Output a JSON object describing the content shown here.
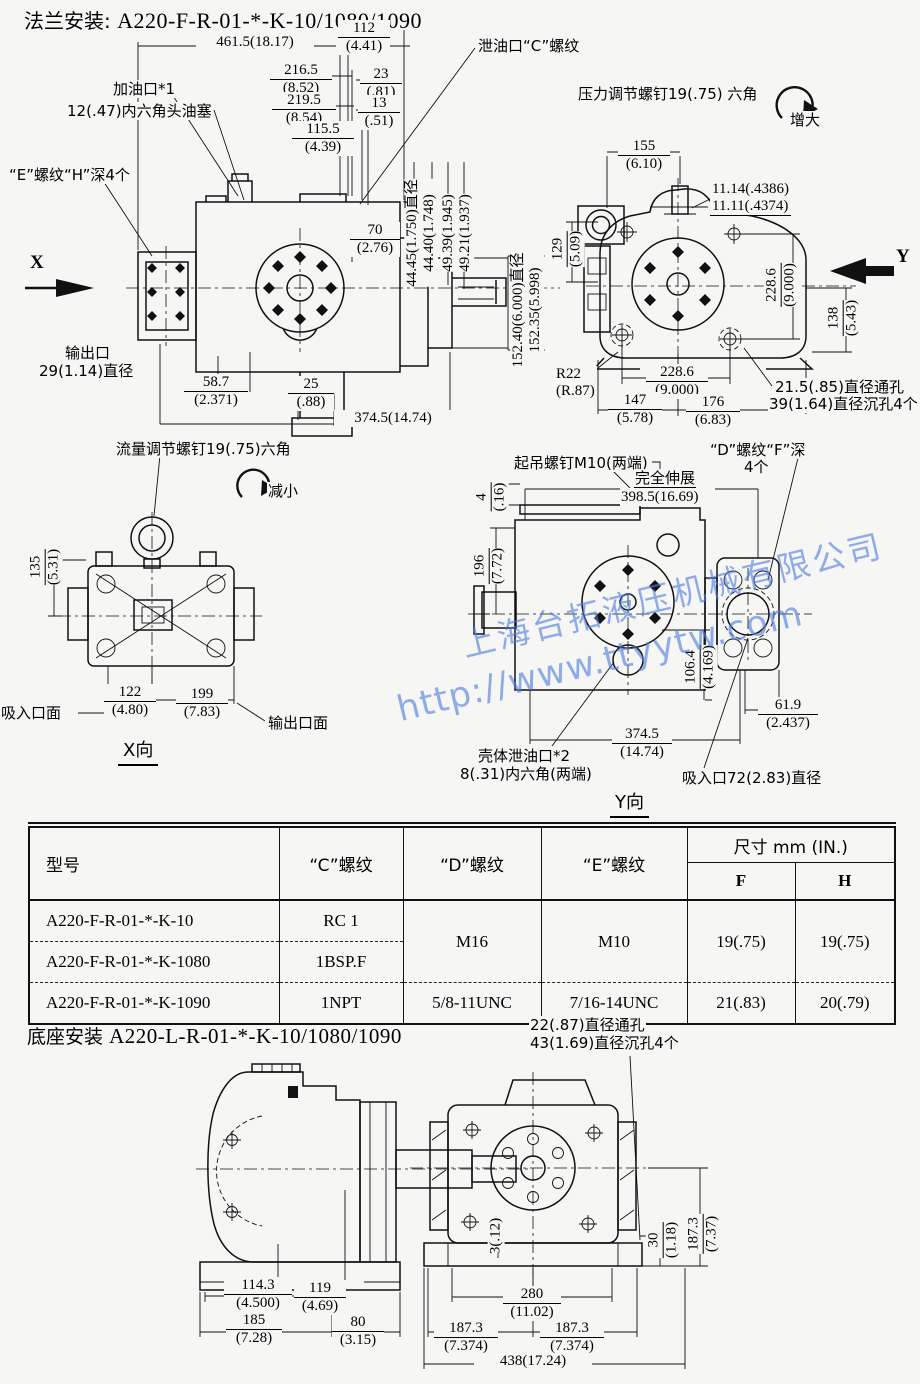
{
  "title": {
    "prefix": "法兰安装:",
    "model": "A220-F-R-01-*-K-10/1080/1090"
  },
  "watermark": {
    "line1": "上海台拓液压机械有限公司",
    "line2": "http://www.ttyytw.com"
  },
  "flange_view": {
    "labels": {
      "fill_port": "加油口*1",
      "plug": "12(.47)内六角头油塞",
      "e_thread": "“E”螺纹“H”深4个",
      "drain_port": "泄油口“C”螺纹",
      "outlet_line1": "输出口",
      "outlet_line2": "29(1.14)直径",
      "x_arrow": "X"
    },
    "dims": {
      "overall": "461.5(18.17)",
      "d112": {
        "mm": "112",
        "in": "(4.41)"
      },
      "d216": {
        "mm": "216.5",
        "in": "(8.52)"
      },
      "d23": {
        "mm": "23",
        "in": "(.81)"
      },
      "d219": {
        "mm": "219.5",
        "in": "(8.54)"
      },
      "d13": {
        "mm": "13",
        "in": "(.51)"
      },
      "d115": {
        "mm": "115.5",
        "in": "(4.39)"
      },
      "d70": {
        "mm": "70",
        "in": "(2.76)"
      },
      "shaft_dia1": "44.45(1.750)直径",
      "shaft_dia2": "44.40(1.748)",
      "key1": "49.39(1.945)",
      "key2": "49.21(1.937)",
      "pilot1": "152.40(6.000)直径",
      "pilot2": "152.35(5.998)",
      "d587": {
        "mm": "58.7",
        "in": "(2.371)"
      },
      "d25": {
        "mm": "25",
        "in": "(.88)"
      },
      "length": "374.5(14.74)"
    }
  },
  "y_face_view": {
    "labels": {
      "pressure_screw": "压力调节螺钉19(.75) 六角",
      "increase": "增大",
      "y_arrow": "Y",
      "hole1": "21.5(.85)直径通孔",
      "hole2": "39(1.64)直径沉孔4个",
      "r22_line1": "R22",
      "r22_line2": "(R.87)"
    },
    "dims": {
      "d155": {
        "mm": "155",
        "in": "(6.10)"
      },
      "stud1": "11.14(.4386)",
      "stud2": "11.11(.4374)",
      "d129": {
        "mm": "129",
        "in": "(5.09)"
      },
      "d2286r": {
        "mm": "228.6",
        "in": "(9.000)"
      },
      "d138": {
        "mm": "138",
        "in": "(5.43)"
      },
      "d2286b": {
        "mm": "228.6",
        "in": "(9.000)"
      },
      "d147": {
        "mm": "147",
        "in": "(5.78)"
      },
      "d176": {
        "mm": "176",
        "in": "(6.83)"
      }
    }
  },
  "x_view": {
    "labels": {
      "flow_screw": "流量调节螺钉19(.75)六角",
      "decrease": "减小",
      "suction_face": "吸入口面",
      "outlet_face": "输出口面",
      "view_name": "X向"
    },
    "dims": {
      "d135": {
        "mm": "135",
        "in": "(5.31)"
      },
      "d122": {
        "mm": "122",
        "in": "(4.80)"
      },
      "d199": {
        "mm": "199",
        "in": "(7.83)"
      }
    }
  },
  "y_view": {
    "labels": {
      "lift_screw": "起吊螺钉M10(两端)",
      "d_thread1": "“D”螺纹“F”深",
      "d_thread2": "4个",
      "extend": "完全伸展",
      "extend_dim": "398.5(16.69)",
      "case_drain1": "壳体泄油口*2",
      "case_drain2": "8(.31)内六角(两端)",
      "suction_port": "吸入口72(2.83)直径",
      "view_name": "Y向"
    },
    "dims": {
      "d4": {
        "mm": "4",
        "in": "(.16)"
      },
      "d196": {
        "mm": "196",
        "in": "(7.72)"
      },
      "d1064": {
        "mm": "106.4",
        "in": "(4.169)"
      },
      "d619": {
        "mm": "61.9",
        "in": "(2.437)"
      },
      "d3745": {
        "mm": "374.5",
        "in": "(14.74)"
      }
    }
  },
  "spec_table": {
    "headers": {
      "model": "型号",
      "c": "“C”螺纹",
      "d": "“D”螺纹",
      "e": "“E”螺纹",
      "size": "尺寸 mm (IN.)",
      "f": "F",
      "h": "H"
    },
    "rows": [
      {
        "model": "A220-F-R-01-*-K-10",
        "c": "RC 1"
      },
      {
        "model": "A220-F-R-01-*-K-1080",
        "c": "1BSP.F"
      },
      {
        "model": "A220-F-R-01-*-K-1090",
        "c": "1NPT",
        "d": "5/8-11UNC",
        "e": "7/16-14UNC",
        "f": "21(.83)",
        "h": "20(.79)"
      }
    ],
    "merged": {
      "d": "M16",
      "e": "M10",
      "f": "19(.75)",
      "h": "19(.75)"
    }
  },
  "base_section": {
    "title": {
      "prefix": "底座安装",
      "model": "A220-L-R-01-*-K-10/1080/1090"
    },
    "labels": {
      "hole1": "22(.87)直径通孔",
      "hole2": "43(1.69)直径沉孔4个"
    },
    "dims": {
      "d1143": {
        "mm": "114.3",
        "in": "(4.500)"
      },
      "d119": {
        "mm": "119",
        "in": "(4.69)"
      },
      "d185": {
        "mm": "185",
        "in": "(7.28)"
      },
      "d80": {
        "mm": "80",
        "in": "(3.15)"
      },
      "d3": "3(.12)",
      "d30": {
        "mm": "30",
        "in": "(1.18)"
      },
      "d1873v": {
        "mm": "187.3",
        "in": "(7.37)"
      },
      "d280": {
        "mm": "280",
        "in": "(11.02)"
      },
      "d1873a": {
        "mm": "187.3",
        "in": "(7.374)"
      },
      "d1873b": {
        "mm": "187.3",
        "in": "(7.374)"
      },
      "d438": "438(17.24)"
    }
  }
}
